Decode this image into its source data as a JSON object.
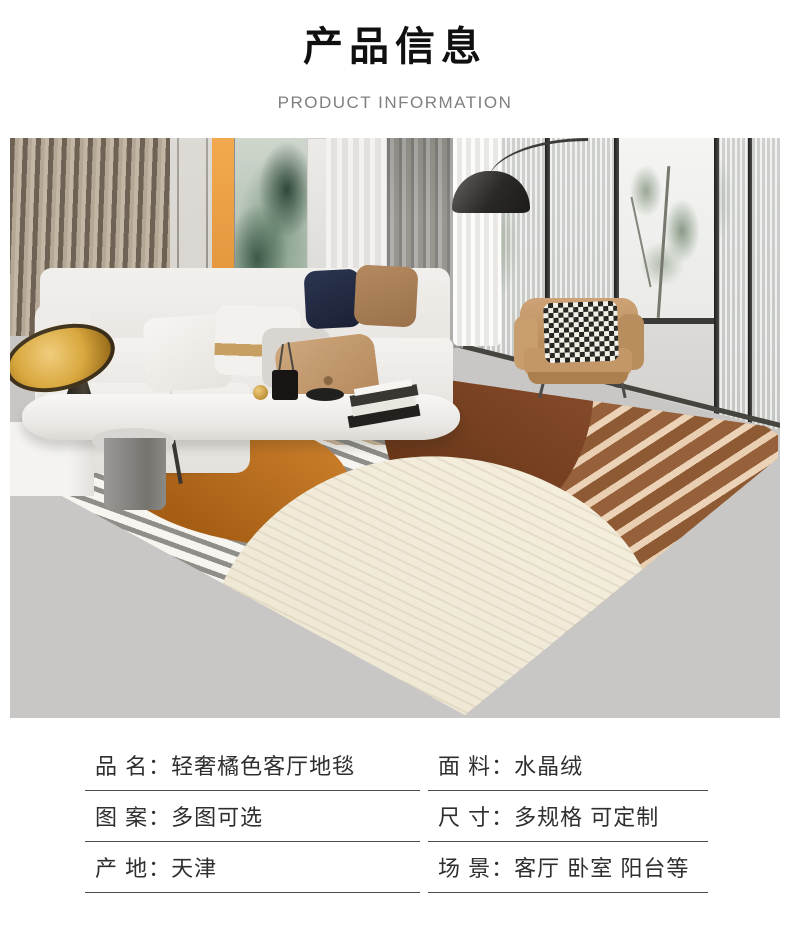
{
  "header": {
    "title": "产品信息",
    "subtitle": "PRODUCT INFORMATION"
  },
  "photo": {
    "alt": "现代客厅场景：木格栅墙、绿色抽象挂画、灰色窗帘、弧形落地灯、白色布艺沙发、橘色皮质单人椅、橙棕灰几何条纹地毯、灰色大理石地面",
    "palette": {
      "rug_orange_blob": "#b4671f",
      "rug_brown_semicircle": "#6e3a1c",
      "rug_stripe_brown": "#8e5a33",
      "rug_stripe_cream": "#ecd2b6",
      "rug_gray_stripe": "#8f8e89",
      "rug_cream_blob": "#f2ebdb",
      "wood_slat": "#b4a795",
      "accent_art_orange": "#f0a851",
      "armchair_leather": "#c49768"
    }
  },
  "specs": [
    {
      "label": "品 名：",
      "value": "轻奢橘色客厅地毯"
    },
    {
      "label": "面 料：",
      "value": "水晶绒"
    },
    {
      "label": "图 案：",
      "value": "多图可选"
    },
    {
      "label": "尺 寸：",
      "value": "多规格 可定制"
    },
    {
      "label": "产 地：",
      "value": "天津"
    },
    {
      "label": "场 景：",
      "value": "客厅 卧室 阳台等"
    }
  ]
}
